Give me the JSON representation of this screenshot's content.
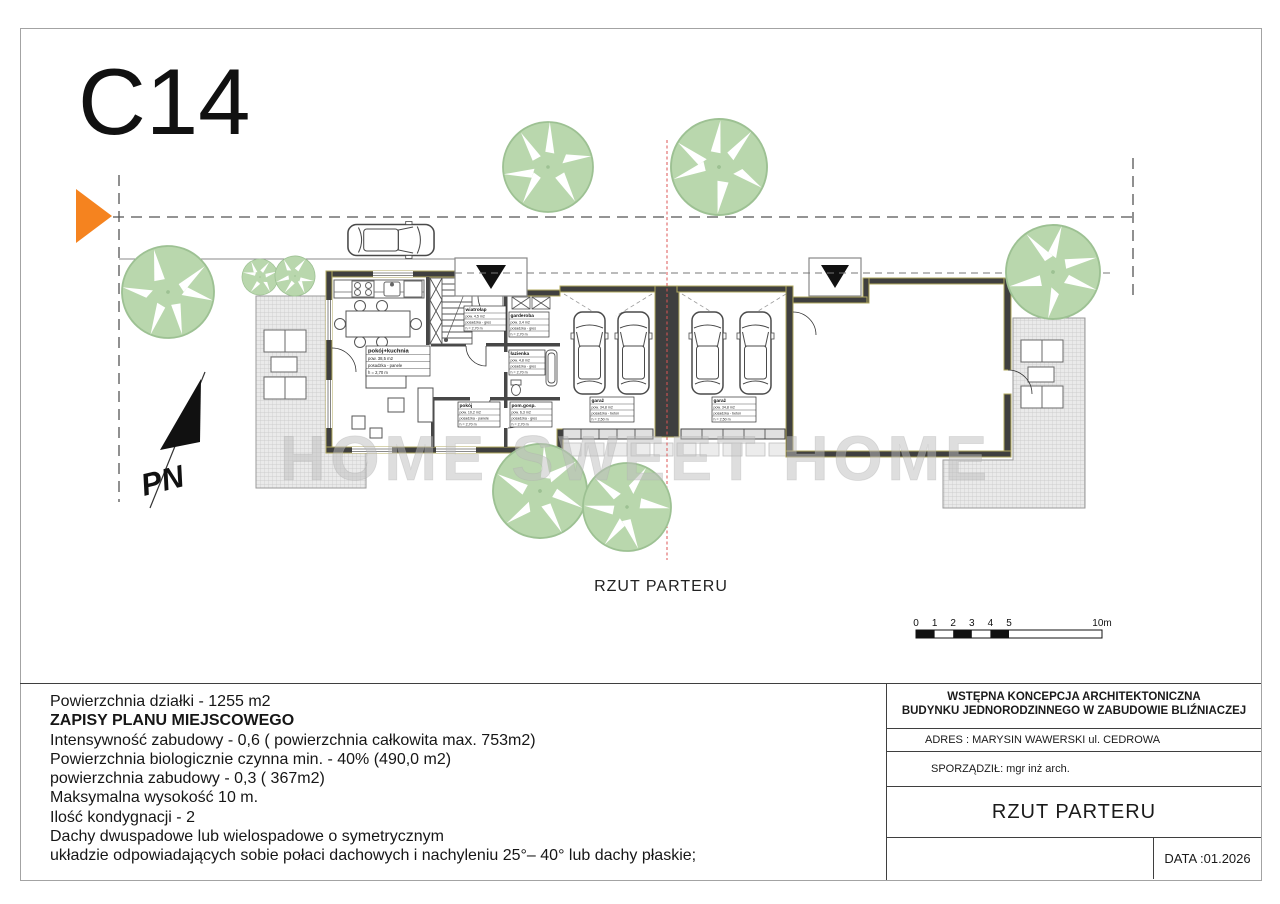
{
  "sheet": {
    "code": "C14",
    "plan_caption": "RZUT PARTERU",
    "watermark": "HOME SWEET HOME",
    "north_label": "PN"
  },
  "scale_bar": {
    "ticks": [
      "0",
      "1",
      "2",
      "3",
      "4",
      "5"
    ],
    "end_label": "10m"
  },
  "rooms": {
    "salon": {
      "name": "pokój+kuchnia",
      "r1": "pow. 38,5 m2",
      "r2": "posadzka - panele",
      "r3": "h = 2,70 m"
    },
    "wiatrolap": {
      "name": "wiatrołap",
      "r1": "pow. 4,5 m2",
      "r2": "posadzka - gres",
      "r3": "h = 2,70 m"
    },
    "garderoba": {
      "name": "garderoba",
      "r1": "pow. 3,4 m2",
      "r2": "posadzka - gres",
      "r3": "h = 2,70 m"
    },
    "lazienka": {
      "name": "łazienka",
      "r1": "pow. 4,8 m2",
      "r2": "posadzka - gres",
      "r3": "h = 2,70 m"
    },
    "pokoj": {
      "name": "pokój",
      "r1": "pow. 10,2 m2",
      "r2": "posadzka - panele",
      "r3": "h = 2,70 m"
    },
    "pomgosp": {
      "name": "pom.gosp.",
      "r1": "pow. 6,3 m2",
      "r2": "posadzka - gres",
      "r3": "h = 2,70 m"
    },
    "garaz1": {
      "name": "garaż",
      "r1": "pow. 34,8 m2",
      "r2": "posadzka - beton",
      "r3": "h = 2,50 m"
    },
    "garaz2": {
      "name": "garaż",
      "r1": "pow. 34,8 m2",
      "r2": "posadzka - beton",
      "r3": "h = 2,50 m"
    }
  },
  "regulations": {
    "line1": "Powierzchnia działki - 1255 m2",
    "line2": "ZAPISY PLANU MIEJSCOWEGO",
    "line3": "Intensywność zabudowy - 0,6  ( powierzchnia całkowita max. 753m2)",
    "line4": "Powierzchnia biologicznie czynna min.  - 40% (490,0 m2)",
    "line5": "powierzchnia zabudowy - 0,3 ( 367m2)",
    "line6": "Maksymalna wysokość 10 m.",
    "line7": "Ilość kondygnacji - 2",
    "line8": "Dachy dwuspadowe lub wielospadowe o symetrycznym",
    "line9": "układzie odpowiadających sobie połaci dachowych i nachyleniu 25°– 40° lub dachy płaskie;"
  },
  "title_block": {
    "project_line1": "WSTĘPNA KONCEPCJA ARCHITEKTONICZNA",
    "project_line2": "BUDYNKU JEDNORODZINNEGO W ZABUDOWIE BLIŹNIACZEJ",
    "address": "ADRES : MARYSIN WAWERSKI ul. CEDROWA",
    "author": "SPORZĄDZIŁ: mgr inż arch.",
    "drawing_title": "RZUT PARTERU",
    "date": "DATA :01.2026"
  }
}
